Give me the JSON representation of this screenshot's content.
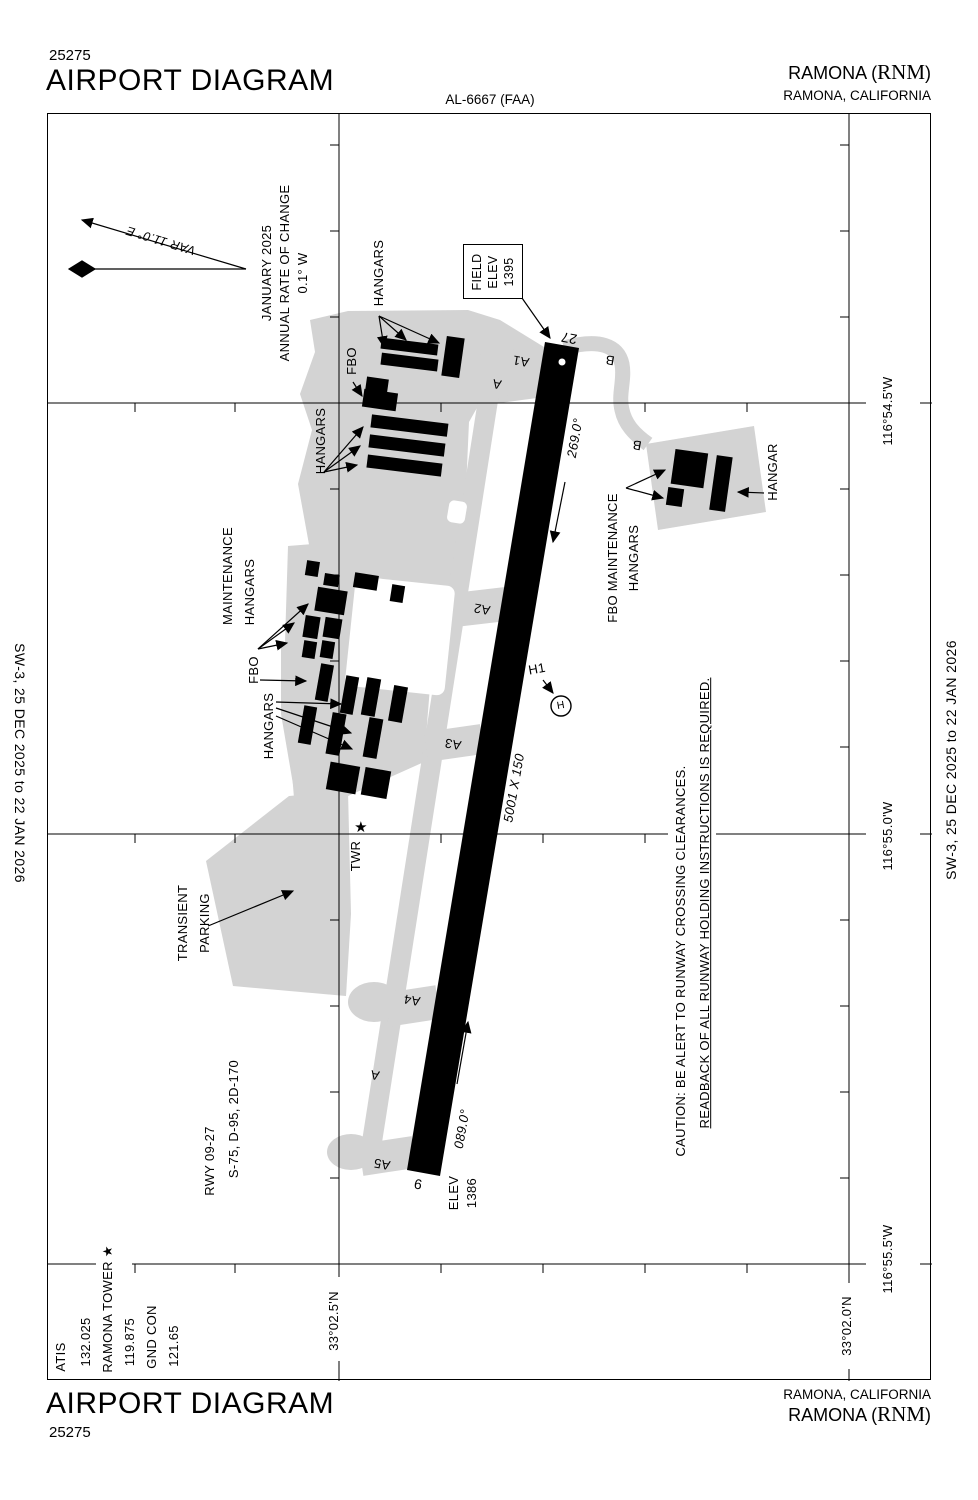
{
  "colors": {
    "ink": "#000000",
    "apron": "#d3d3d3",
    "background": "#ffffff"
  },
  "header": {
    "chart_number": "25275",
    "title": "AIRPORT DIAGRAM",
    "chart_id": "AL-6667 (FAA)",
    "airport_prefix": "RAMONA (",
    "airport_code": "RNM",
    "airport_suffix": ")",
    "location": "RAMONA, CALIFORNIA"
  },
  "footer": {
    "chart_number": "25275",
    "title": "AIRPORT DIAGRAM",
    "location": "RAMONA, CALIFORNIA",
    "airport_prefix": "RAMONA (",
    "airport_code": "RNM",
    "airport_suffix": ")"
  },
  "edges": {
    "left": "SW-3,  25 DEC 2025  to  22 JAN 2026",
    "right": "SW-3,  25 DEC 2025  to  22 JAN 2026"
  },
  "frequencies": {
    "atis_label": "ATIS",
    "atis": "132.025",
    "tower_label": "RAMONA TOWER",
    "tower_star": "★",
    "tower": "119.875",
    "ground_label": "GND CON",
    "ground": "121.65"
  },
  "runway_info": {
    "line1": "RWY 09-27",
    "line2": "S-75, D-95, 2D-170"
  },
  "variation": {
    "line1": "JANUARY 2025",
    "line2": "ANNUAL RATE OF CHANGE",
    "line3": "0.1° W",
    "var": "VAR 11.0° E"
  },
  "caution": {
    "line1": "CAUTION: BE ALERT TO RUNWAY CROSSING CLEARANCES.",
    "line2": "READBACK OF ALL RUNWAY HOLDING INSTRUCTIONS IS REQUIRED."
  },
  "field_elev": {
    "line1": "FIELD",
    "line2": "ELEV",
    "line3": "1395"
  },
  "runway": {
    "id_27": "27",
    "id_9": "9",
    "dimensions": "5001 X 150",
    "heading_east": "089.0°",
    "heading_west": "269.0°",
    "elev_label": "ELEV",
    "elev_value": "1386"
  },
  "coordinates": {
    "lon_1": "116°54.5'W",
    "lon_2": "116°55.0'W",
    "lon_3": "116°55.5'W",
    "lat_1": "33°02.5'N",
    "lat_2": "33°02.0'N"
  },
  "labels": {
    "hangars_top": "HANGARS",
    "fbo_top": "FBO",
    "hangars_mid": "HANGARS",
    "maintenance_1": "MAINTENANCE",
    "maintenance_2": "HANGARS",
    "fbo_mid": "FBO",
    "hangars_low": "HANGARS",
    "transient_1": "TRANSIENT",
    "transient_2": "PARKING",
    "tower": "TWR",
    "tower_star": "★",
    "helipad": "H1",
    "helipad_h": "H",
    "fbo_maint_1": "FBO MAINTENANCE",
    "fbo_maint_2": "HANGARS",
    "hangar_east": "HANGAR"
  },
  "taxiways": {
    "a1": "A1",
    "a_top": "A",
    "a2": "A2",
    "a3": "A3",
    "a4": "A4",
    "a5": "A5",
    "a_south": "A",
    "b_top": "B",
    "b_mid": "B"
  }
}
